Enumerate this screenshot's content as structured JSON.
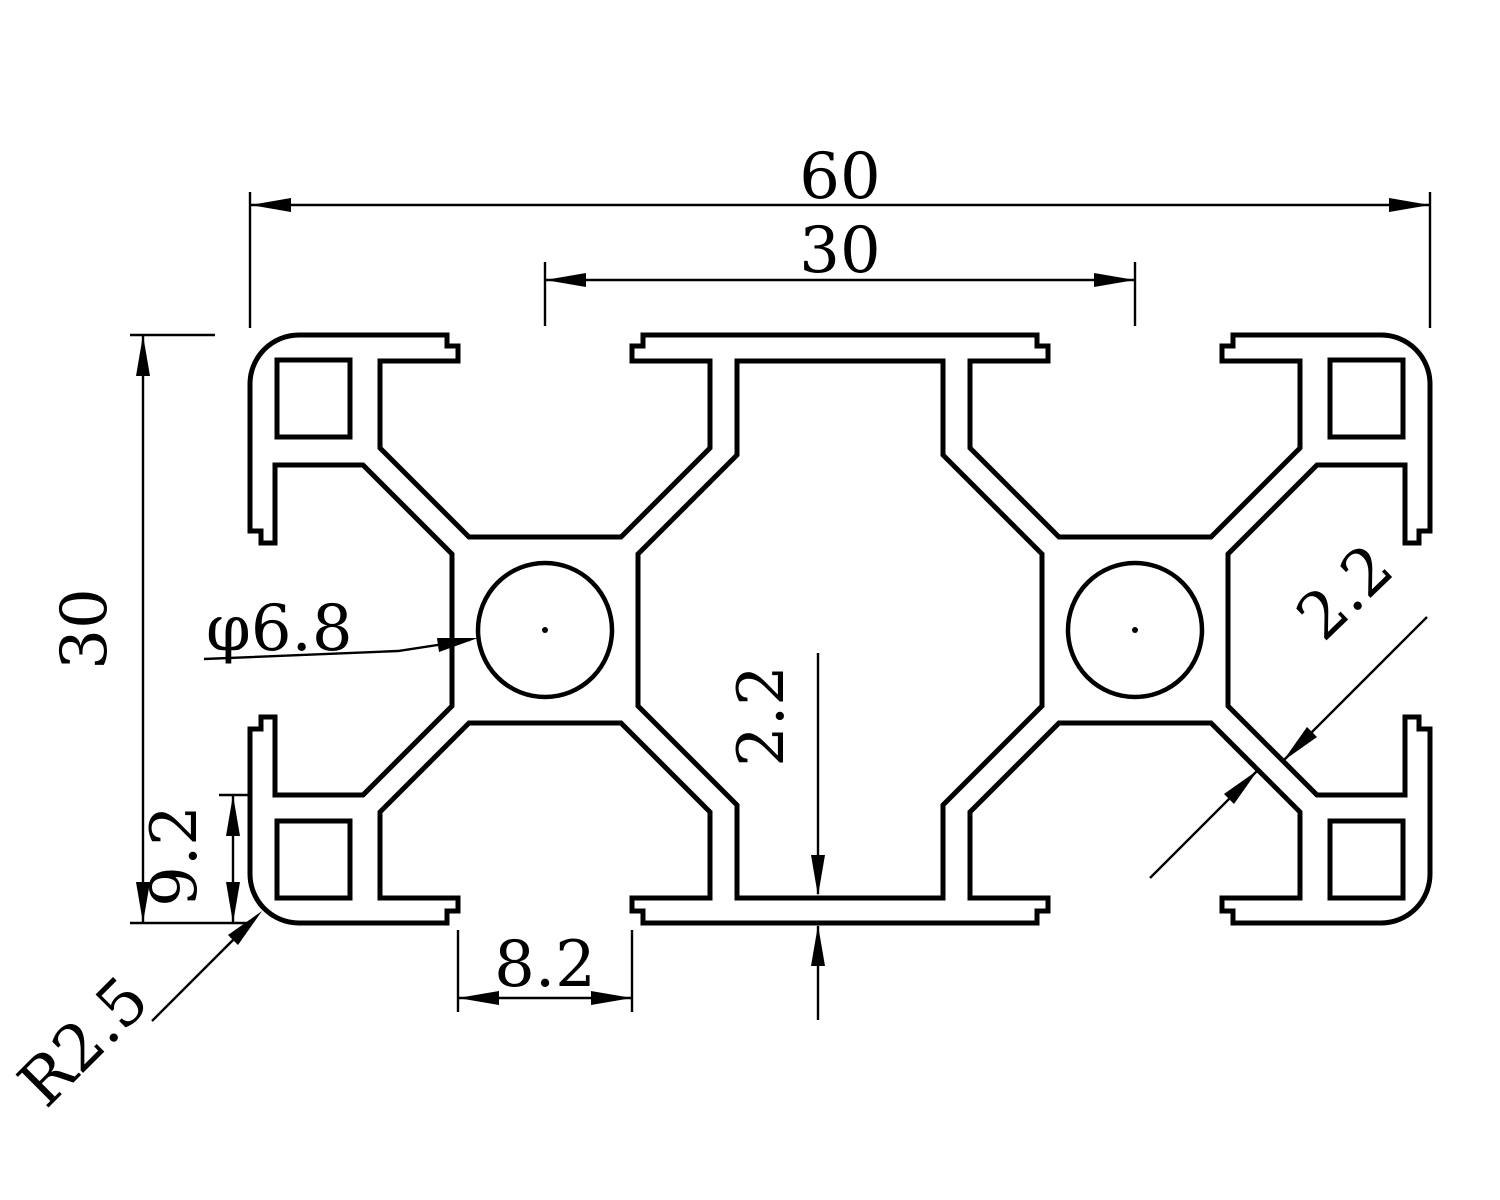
{
  "drawing": {
    "kind": "aluminium extrusion profile cross-section",
    "background_color": "#ffffff",
    "line_color": "#000000"
  },
  "dims": {
    "overall_width": "60",
    "slot_pitch": "30",
    "overall_height": "30",
    "side_ledge": "9.2",
    "slot_opening": "8.2",
    "wall_thickness": "2.2",
    "web_thickness": "2.2",
    "hole_diameter": "φ6.8",
    "corner_radius": "R2.5"
  }
}
